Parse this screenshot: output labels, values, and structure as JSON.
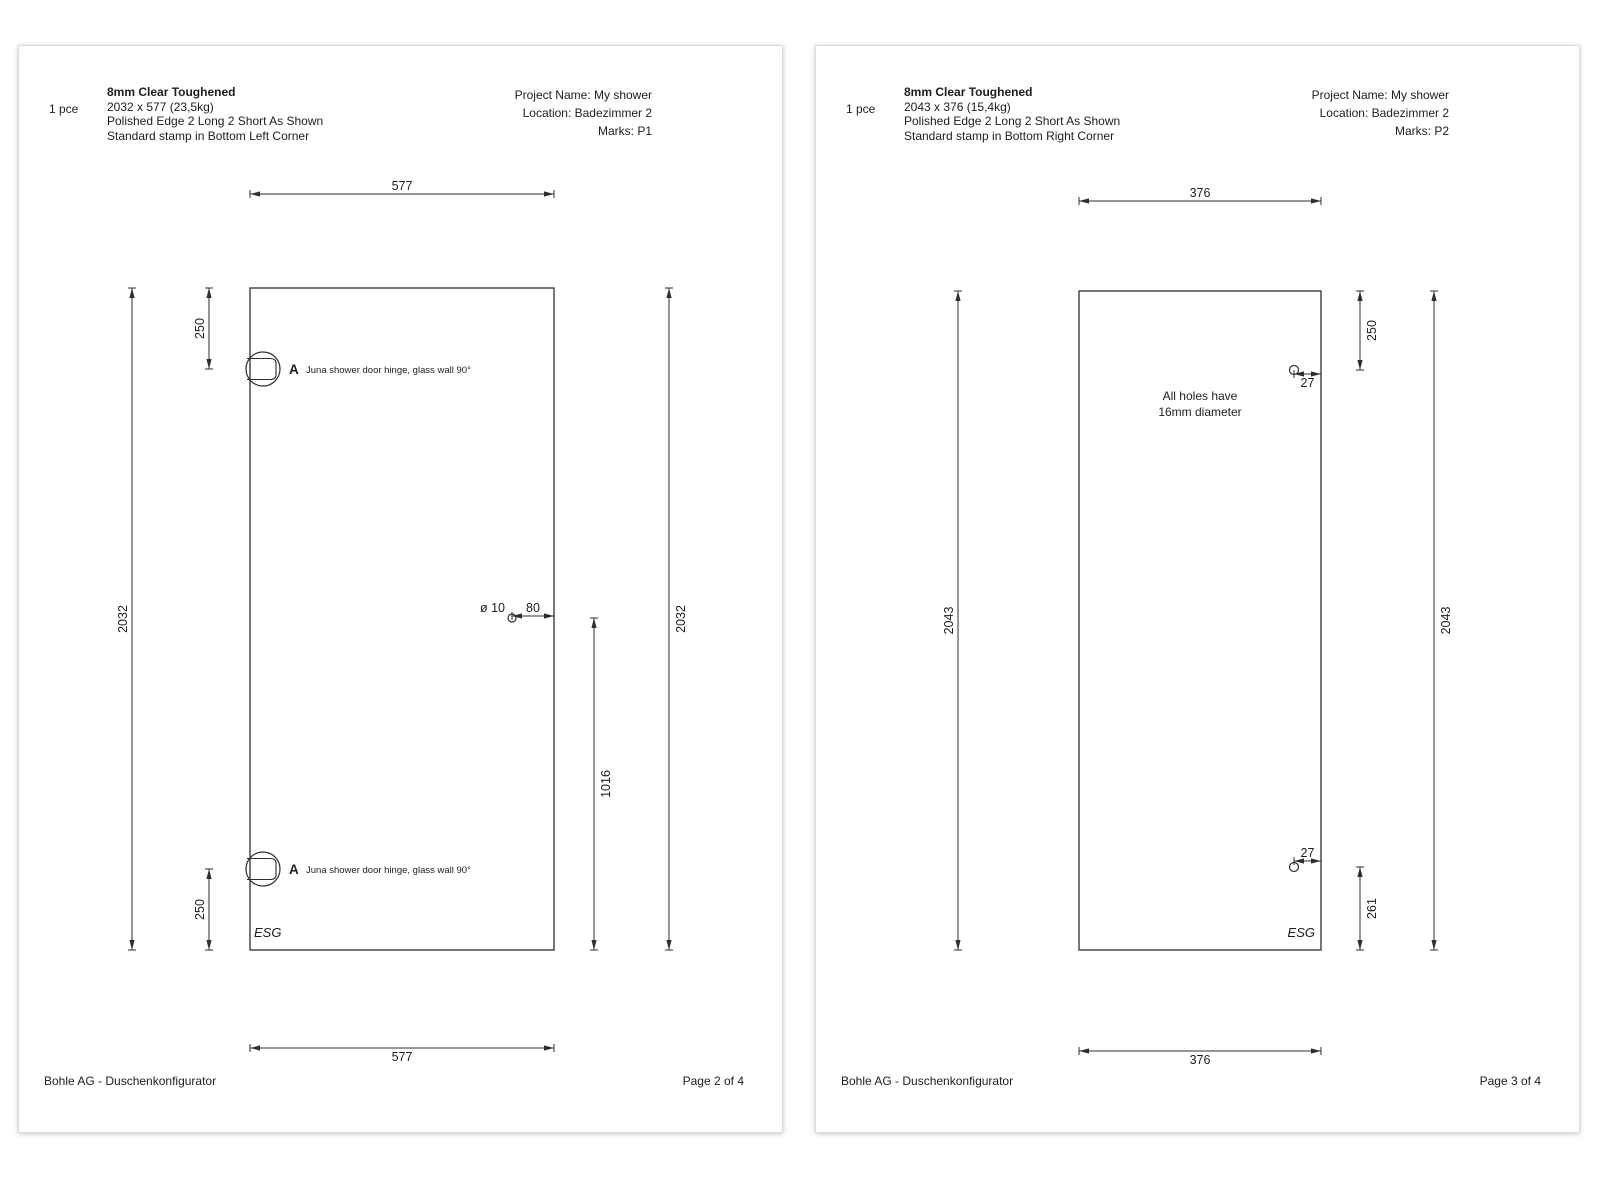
{
  "colors": {
    "line": "#2e2e2e",
    "text": "#1d1d1d",
    "page_bg": "#ffffff"
  },
  "pages": [
    {
      "header": {
        "qty": "1 pce",
        "title": "8mm Clear Toughened",
        "size": "2032 x 577  (23,5kg)",
        "edges": "Polished Edge 2 Long 2 Short As Shown",
        "stamp": "Standard stamp in Bottom Left Corner",
        "project": "Project Name: My shower",
        "location": "Location: Badezimmer 2",
        "marks": "Marks: P1"
      },
      "footer": {
        "brand": "Bohle AG - Duschenkonfigurator",
        "page": "Page 2 of 4"
      },
      "drawing": {
        "panel": {
          "x": 231,
          "y": 242,
          "w": 304,
          "h": 662
        },
        "hdims": [
          {
            "x1": 231,
            "x2": 535,
            "y": 148,
            "label": "577",
            "pos": "above"
          },
          {
            "x1": 231,
            "x2": 535,
            "y": 1002,
            "label": "577",
            "pos": "below"
          },
          {
            "x1": 493,
            "x2": 535,
            "y": 570,
            "label": "80",
            "pos": "above"
          }
        ],
        "vdims": [
          {
            "x": 113,
            "y1": 242,
            "y2": 904,
            "label": "2032",
            "side": "left"
          },
          {
            "x": 650,
            "y1": 242,
            "y2": 904,
            "label": "2032",
            "side": "right"
          },
          {
            "x": 190,
            "y1": 242,
            "y2": 323,
            "label": "250",
            "side": "left"
          },
          {
            "x": 190,
            "y1": 823,
            "y2": 904,
            "label": "250",
            "side": "left"
          },
          {
            "x": 575,
            "y1": 572,
            "y2": 904,
            "label": "1016",
            "side": "right"
          }
        ],
        "holes": [
          {
            "x": 493,
            "y": 572,
            "r": 4,
            "label": "ø 10",
            "lx": 486,
            "ly": 566
          }
        ],
        "hinges": [
          {
            "x": 244,
            "y": 323,
            "r": 17,
            "tag": "A",
            "note": "Juna shower door hinge, glass wall 90°"
          },
          {
            "x": 244,
            "y": 823,
            "r": 17,
            "tag": "A",
            "note": "Juna shower door hinge, glass wall 90°"
          }
        ],
        "note": null,
        "stamp": {
          "x": 235,
          "y": 891,
          "anchor": "start",
          "text": "ESG"
        }
      }
    },
    {
      "header": {
        "qty": "1 pce",
        "title": "8mm Clear Toughened",
        "size": "2043 x 376  (15,4kg)",
        "edges": "Polished Edge 2 Long 2 Short As Shown",
        "stamp": "Standard stamp in Bottom Right Corner",
        "project": "Project Name: My shower",
        "location": "Location: Badezimmer 2",
        "marks": "Marks: P2"
      },
      "footer": {
        "brand": "Bohle AG - Duschenkonfigurator",
        "page": "Page 3 of 4"
      },
      "drawing": {
        "panel": {
          "x": 263,
          "y": 245,
          "w": 242,
          "h": 659
        },
        "hdims": [
          {
            "x1": 263,
            "x2": 505,
            "y": 155,
            "label": "376",
            "pos": "above"
          },
          {
            "x1": 263,
            "x2": 505,
            "y": 1005,
            "label": "376",
            "pos": "below"
          },
          {
            "x1": 478,
            "x2": 505,
            "y": 328,
            "label": "27",
            "pos": "below"
          },
          {
            "x1": 478,
            "x2": 505,
            "y": 815,
            "label": "27",
            "pos": "above"
          }
        ],
        "vdims": [
          {
            "x": 142,
            "y1": 245,
            "y2": 904,
            "label": "2043",
            "side": "left"
          },
          {
            "x": 618,
            "y1": 245,
            "y2": 904,
            "label": "2043",
            "side": "right"
          },
          {
            "x": 544,
            "y1": 245,
            "y2": 324,
            "label": "250",
            "side": "right"
          },
          {
            "x": 544,
            "y1": 821,
            "y2": 904,
            "label": "261",
            "side": "right"
          }
        ],
        "holes": [
          {
            "x": 478,
            "y": 324,
            "r": 4.5
          },
          {
            "x": 478,
            "y": 821,
            "r": 4.5
          }
        ],
        "hinges": [],
        "note": {
          "x": 384,
          "y": 354,
          "lines": [
            "All holes have",
            "16mm diameter"
          ]
        },
        "stamp": {
          "x": 499,
          "y": 891,
          "anchor": "end",
          "text": "ESG"
        }
      }
    }
  ]
}
